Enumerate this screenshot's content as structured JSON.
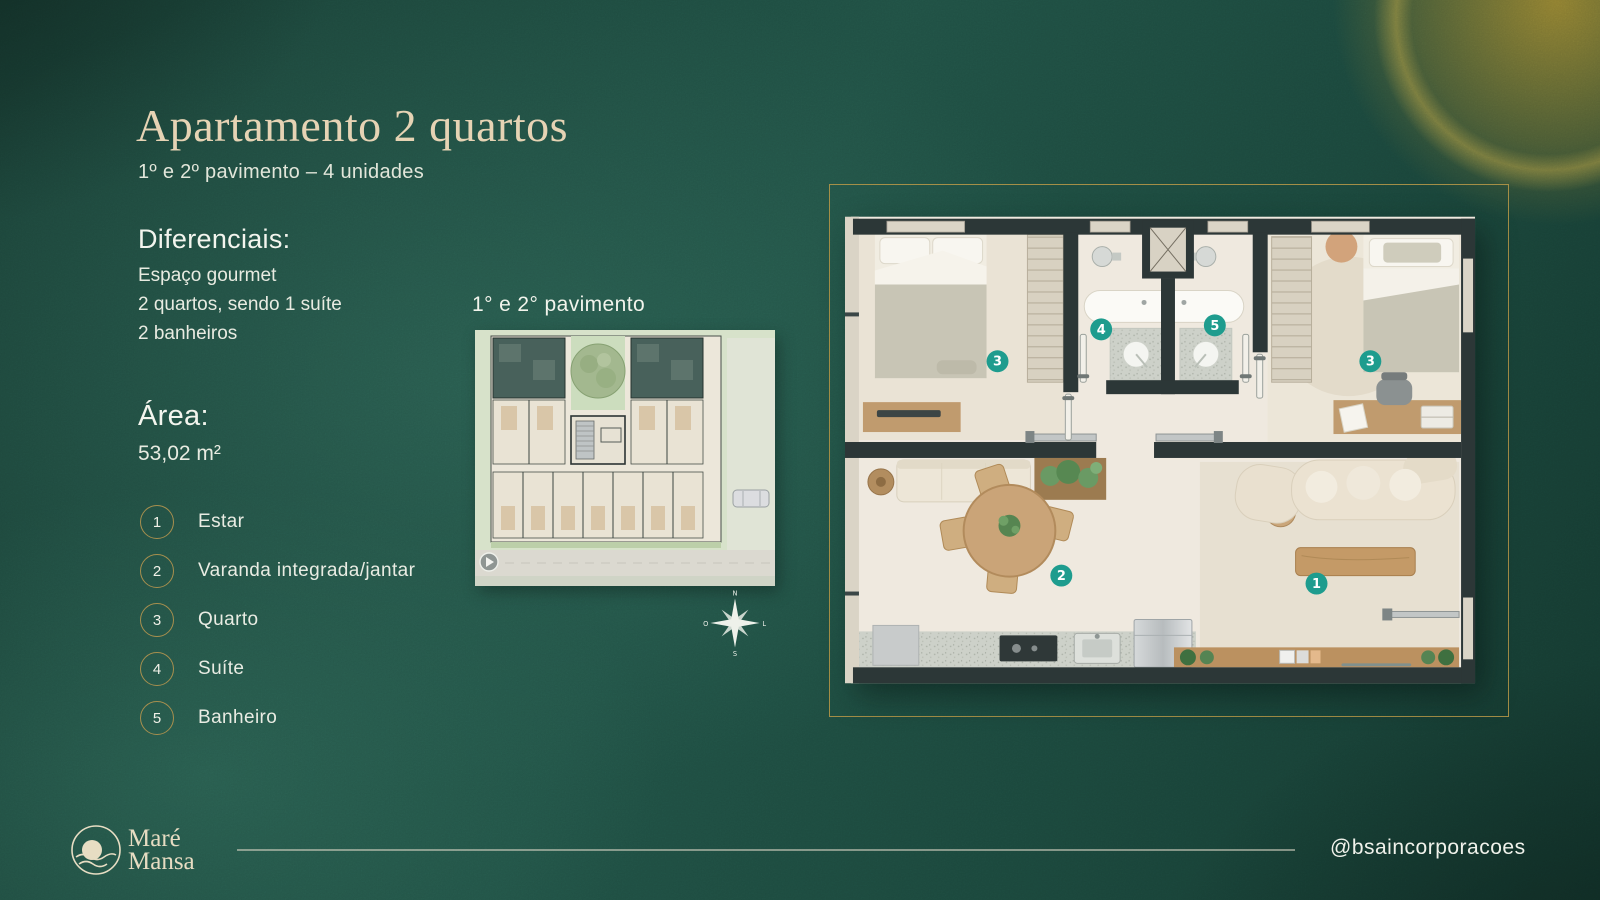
{
  "colors": {
    "accent_gold": "#a78f4e",
    "marker_teal": "#1e9c8e",
    "title_beige": "#e6d3b4"
  },
  "header": {
    "title": "Apartamento 2 quartos",
    "subtitle": "1º e 2º pavimento – 4 unidades"
  },
  "diferenciais": {
    "heading": "Diferenciais:",
    "items": [
      "Espaço gourmet",
      "2 quartos, sendo 1 suíte",
      "2 banheiros"
    ]
  },
  "area": {
    "heading": "Área:",
    "value": "53,02 m²"
  },
  "legend": [
    {
      "num": "1",
      "label": "Estar"
    },
    {
      "num": "2",
      "label": "Varanda integrada/jantar"
    },
    {
      "num": "3",
      "label": "Quarto"
    },
    {
      "num": "4",
      "label": "Suíte"
    },
    {
      "num": "5",
      "label": "Banheiro"
    }
  ],
  "miniplan": {
    "label": "1° e 2° pavimento"
  },
  "floorplan": {
    "markers": [
      {
        "num": "3"
      },
      {
        "num": "4"
      },
      {
        "num": "5"
      },
      {
        "num": "3"
      },
      {
        "num": "2"
      },
      {
        "num": "1"
      }
    ]
  },
  "compass": {
    "north": "N",
    "east": "L",
    "south": "S",
    "west": "O"
  },
  "footer": {
    "brand_line1": "Maré",
    "brand_line2": "Mansa",
    "handle": "@bsaincorporacoes"
  }
}
